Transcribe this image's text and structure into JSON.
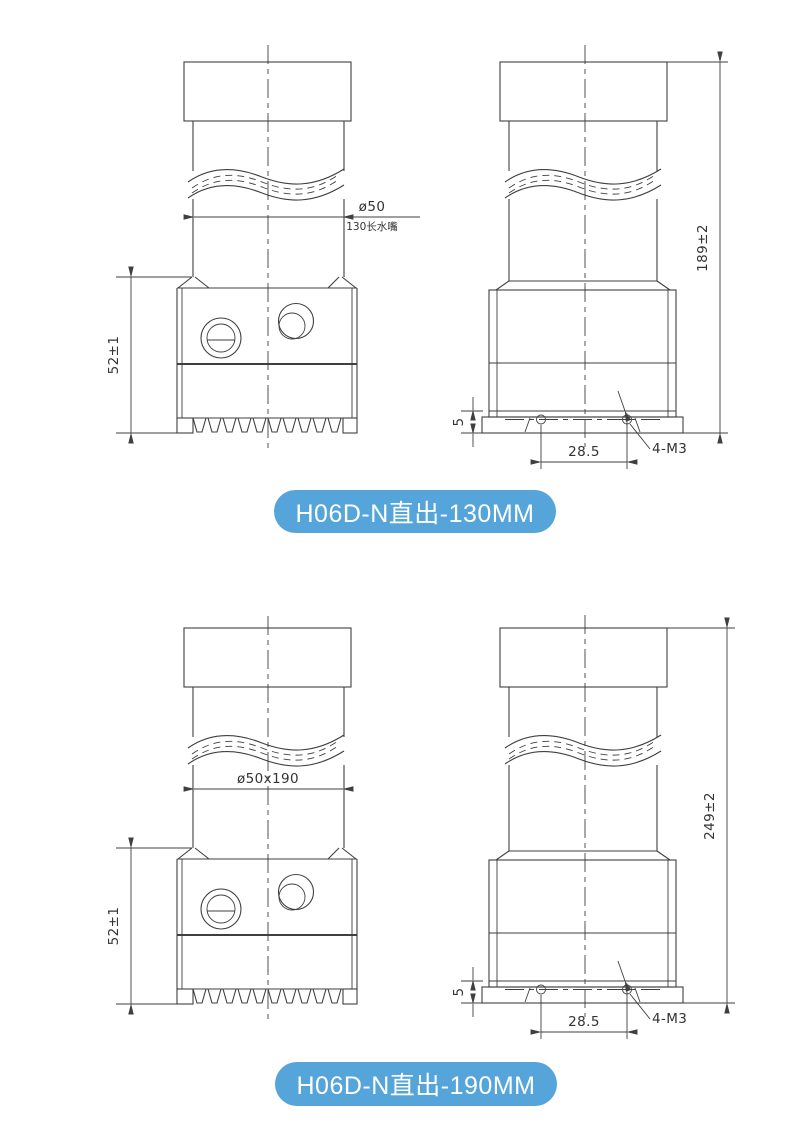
{
  "colors": {
    "line": "#3f3f3f",
    "badge_bg": "#55a5da",
    "badge_text": "#ffffff"
  },
  "sections": [
    {
      "badge": "H06D-N直出-130MM",
      "front": {
        "width_dim": "ø50",
        "width_note": "130长水嘴",
        "height_dim": "52±1"
      },
      "side": {
        "total_height_dim": "189±2",
        "flange_height_dim": "5",
        "hole_spacing_dim": "28.5",
        "thread_spec": "4-M3"
      }
    },
    {
      "badge": "H06D-N直出-190MM",
      "front": {
        "width_dim": "ø50x190",
        "height_dim": "52±1"
      },
      "side": {
        "total_height_dim": "249±2",
        "flange_height_dim": "5",
        "hole_spacing_dim": "28.5",
        "thread_spec": "4-M3"
      }
    }
  ]
}
